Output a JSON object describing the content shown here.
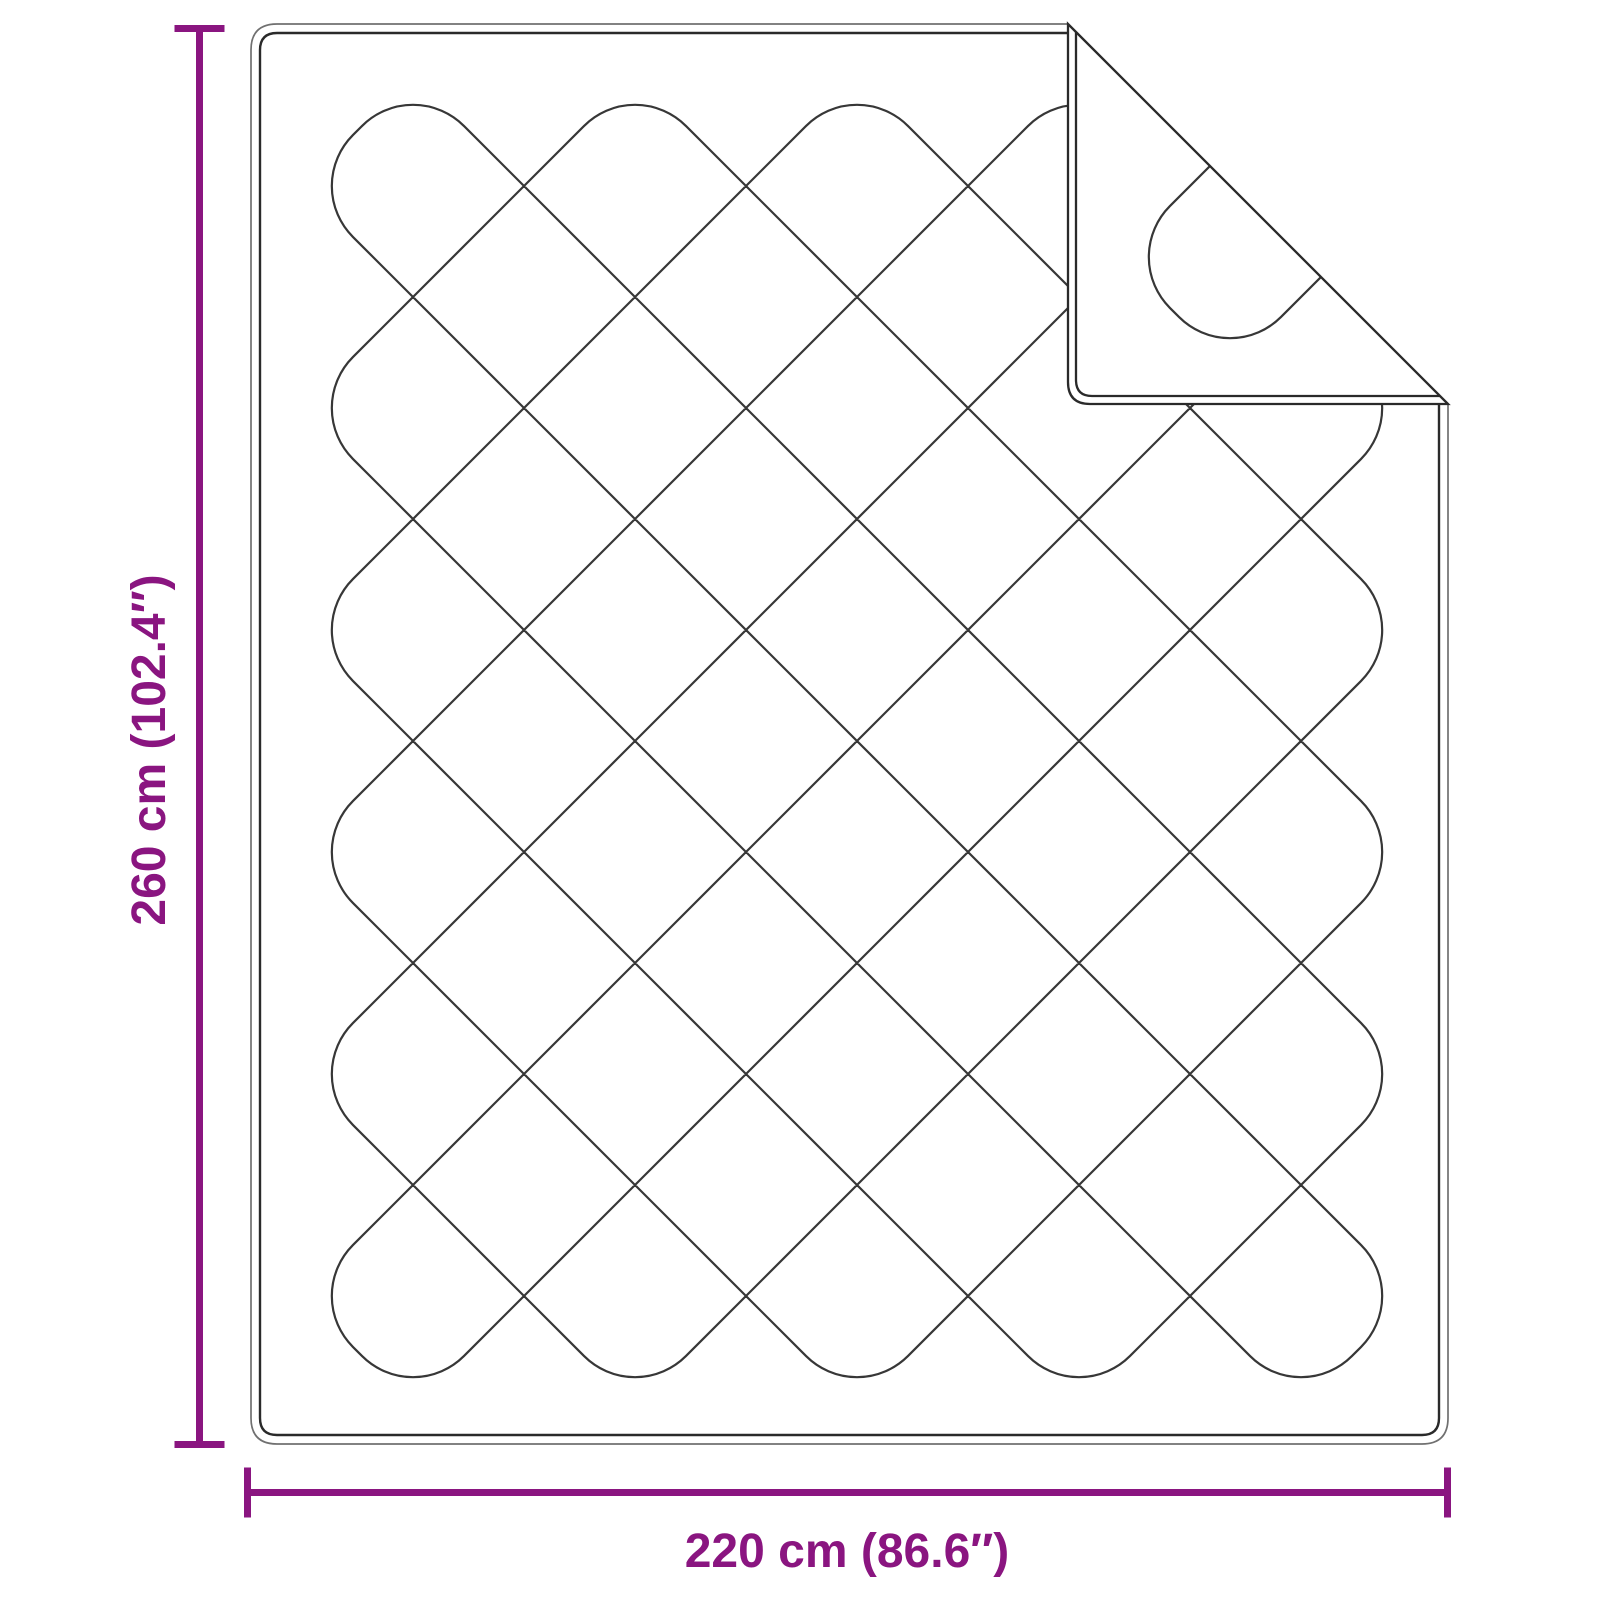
{
  "diagram": {
    "subject": "quilted-duvet-with-folded-corner",
    "dimensions": {
      "height_label": "260 cm (102.4″)",
      "width_label": "220 cm (86.6″)"
    }
  },
  "colors": {
    "accent": "#8a1580",
    "outline_outer": "#707070",
    "outline_inner": "#2a2a2a",
    "quilt_line": "#373737",
    "background": "#ffffff"
  }
}
